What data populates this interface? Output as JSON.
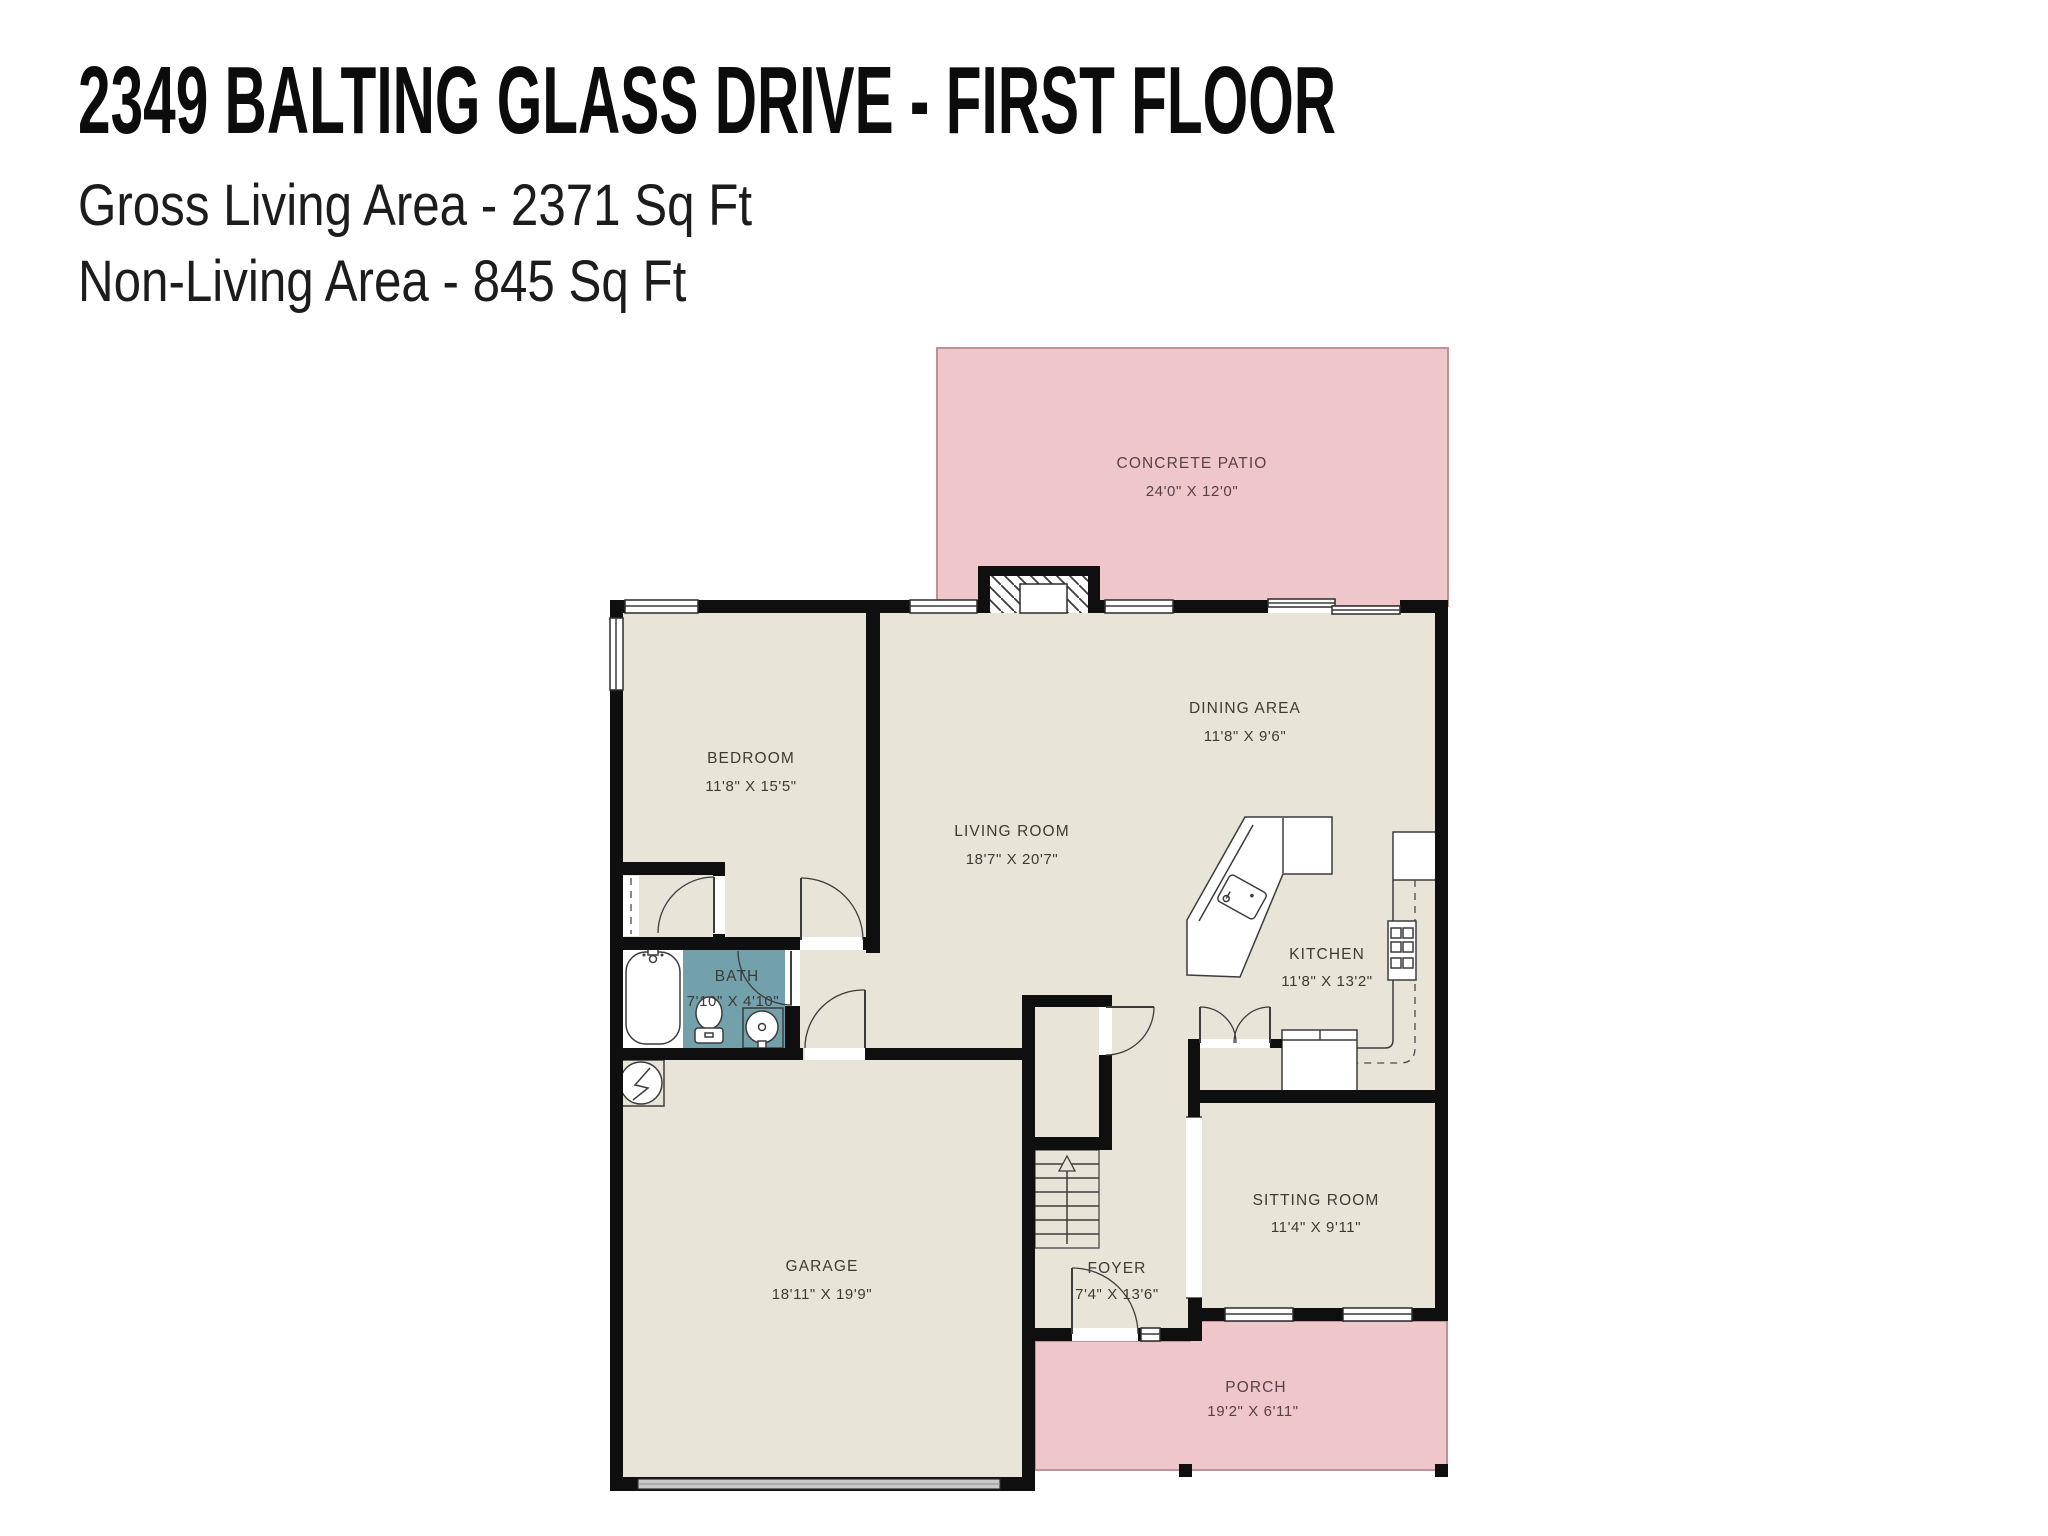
{
  "header": {
    "title": "2349 BALTING GLASS DRIVE - FIRST FLOOR",
    "gross": "Gross Living Area - 2371 Sq Ft",
    "non_living": "Non-Living Area - 845 Sq Ft"
  },
  "rooms": {
    "concrete_patio": {
      "name": "CONCRETE PATIO",
      "dims": "24'0\" X 12'0\""
    },
    "bedroom": {
      "name": "BEDROOM",
      "dims": "11'8\" X 15'5\""
    },
    "living_room": {
      "name": "LIVING ROOM",
      "dims": "18'7\" X 20'7\""
    },
    "dining_area": {
      "name": "DINING AREA",
      "dims": "11'8\" X 9'6\""
    },
    "kitchen": {
      "name": "KITCHEN",
      "dims": "11'8\" X 13'2\""
    },
    "bath": {
      "name": "BATH",
      "dims": "7'10\" X 4'10\""
    },
    "garage": {
      "name": "GARAGE",
      "dims": "18'11\" X 19'9\""
    },
    "foyer": {
      "name": "FOYER",
      "dims": "7'4\" X 13'6\""
    },
    "sitting_room": {
      "name": "SITTING ROOM",
      "dims": "11'4\" X 9'11\""
    },
    "porch": {
      "name": "PORCH",
      "dims": "19'2\" X 6'11\""
    }
  },
  "colors": {
    "floor": "#e8e4d7",
    "outdoor_pink": "#efc6c9",
    "outdoor_outline": "#bd9397",
    "bath_floor": "#72a1ab",
    "wall": "#0f0f0f",
    "label_text": "#3e3b36",
    "outdoor_label_text": "#554247",
    "garage_door": "#c9c9c9"
  },
  "fixtures": [
    "fireplace",
    "bathtub",
    "toilet",
    "sink",
    "water-heater",
    "kitchen-island-sink",
    "range",
    "refrigerator",
    "staircase",
    "garage-door",
    "sliding-door",
    "windows"
  ]
}
